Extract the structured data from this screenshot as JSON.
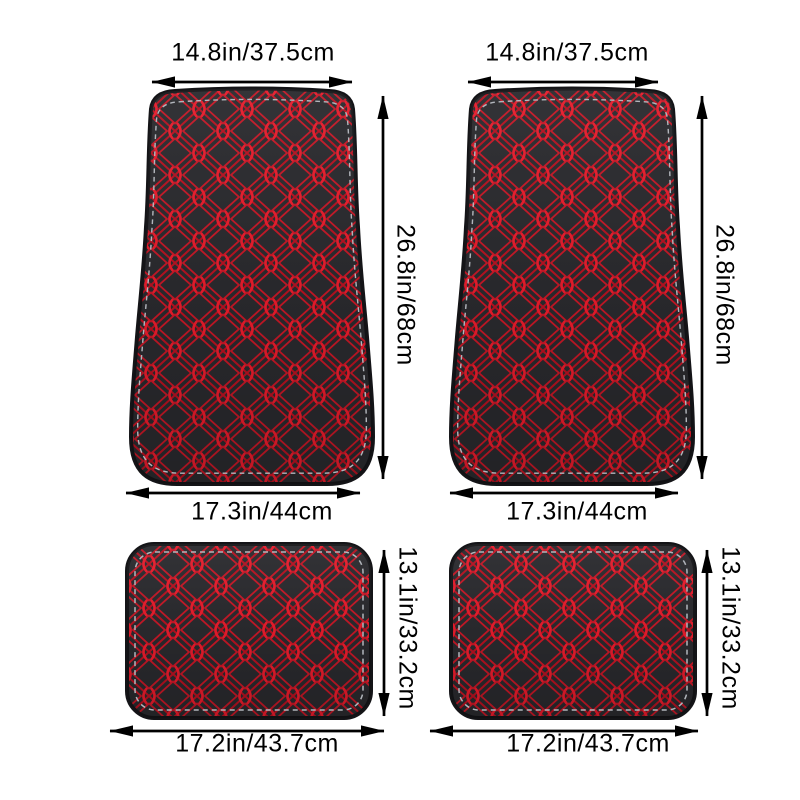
{
  "image": {
    "description": "Four-piece car floor mat set (2 front, 2 rear), black leather with red diamond stitching, annotated with size measurements",
    "background": "#ffffff"
  },
  "colors": {
    "mat_base": "#29292d",
    "mat_edge": "#141417",
    "stitch_red_line": "#b5101f",
    "stitch_red_inner": "#c41625",
    "stitch_red_node": "#e61b2b",
    "perimeter_stitch_gray": "#b2b6bc",
    "dimension_line": "#000000"
  },
  "mats": {
    "front_left": {
      "name": "front floor mat (left)",
      "top_width": "14.8in/37.5cm",
      "height": "26.8in/68cm",
      "bottom_width": "17.3in/44cm"
    },
    "front_right": {
      "name": "front floor mat (right)",
      "top_width": "14.8in/37.5cm",
      "height": "26.8in/68cm",
      "bottom_width": "17.3in/44cm"
    },
    "rear_left": {
      "name": "rear floor mat (left)",
      "height": "13.1in/33.2cm",
      "bottom_width": "17.2in/43.7cm"
    },
    "rear_right": {
      "name": "rear floor mat (right)",
      "height": "13.1in/33.2cm",
      "bottom_width": "17.2in/43.7cm"
    }
  }
}
